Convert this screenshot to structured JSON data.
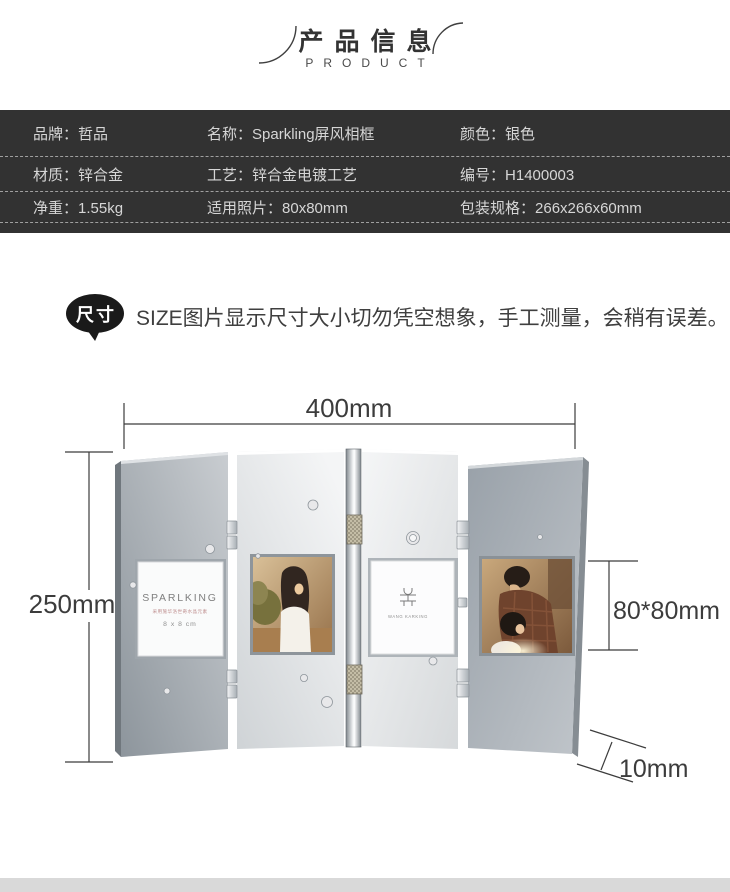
{
  "header": {
    "title": "产品信息",
    "subtitle": "PRODUCT"
  },
  "specs": {
    "rows": [
      [
        {
          "label": "品牌：",
          "value": "哲品"
        },
        {
          "label": "名称：",
          "value": "Sparkling屏风相框"
        },
        {
          "label": "颜色：",
          "value": "银色"
        }
      ],
      [
        {
          "label": "材质：",
          "value": "锌合金"
        },
        {
          "label": "工艺：",
          "value": "锌合金电镀工艺"
        },
        {
          "label": "编号：",
          "value": "H1400003"
        }
      ],
      [
        {
          "label": "净重：",
          "value": "1.55kg"
        },
        {
          "label": "适用照片：",
          "value": "80x80mm"
        },
        {
          "label": "包装规格：",
          "value": "266x266x60mm"
        }
      ]
    ]
  },
  "size_note": {
    "badge": "尺寸",
    "text": "SIZE图片显示尺寸大小切勿凭空想象，手工测量，会稍有误差。"
  },
  "figure": {
    "dim_width": "400mm",
    "dim_height": "250mm",
    "dim_photo": "80*80mm",
    "dim_thickness": "10mm",
    "insert_card": {
      "brand": "SPARLKING",
      "subtitle": "采用施华洛世奇水晶元素",
      "size": "8 x 8 cm"
    },
    "logo_card": {
      "caption": "WANG KARKING"
    }
  },
  "colors": {
    "table_bg": "#323232",
    "table_text": "#d6d6d6",
    "badge_bg": "#1a1a1a",
    "dimension": "#3c3c3c",
    "bottom_bar": "#d9d9d9"
  }
}
